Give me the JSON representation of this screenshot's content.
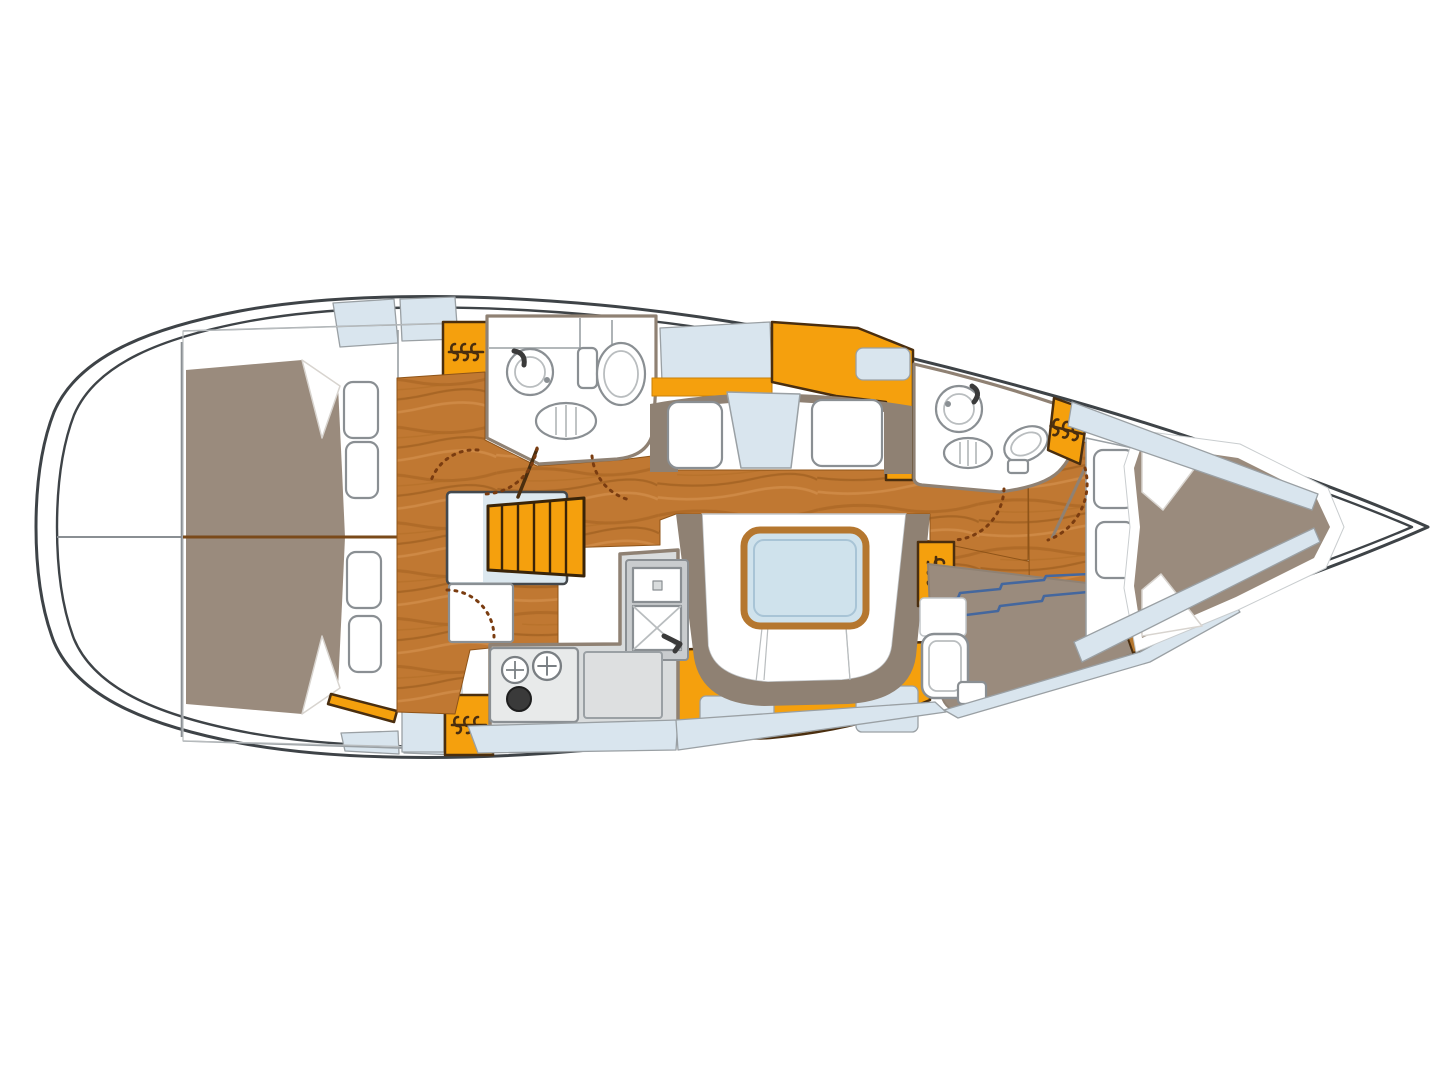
{
  "diagram": {
    "title": "Sailboat interior layout plan (top view)",
    "type": "yacht-floor-plan",
    "orientation": {
      "bow": "right",
      "stern": "left"
    },
    "rooms": [
      {
        "id": "lazarette",
        "name": "Stern lazarette",
        "fixtures": []
      },
      {
        "id": "aft-cabin-top",
        "name": "Aft double cabin (upper)",
        "fixtures": [
          "double-berth",
          "pillow",
          "shelf-locker-hatch",
          "shelf-locker-hatch",
          "hanging-locker",
          "door-swing"
        ]
      },
      {
        "id": "aft-cabin-bottom",
        "name": "Aft double cabin (lower)",
        "fixtures": [
          "double-berth",
          "pillow",
          "shelf-locker-hatch",
          "shelf-locker-hatch",
          "hanging-locker",
          "open-door-leaf",
          "door-swing"
        ]
      },
      {
        "id": "companionway",
        "name": "Companionway",
        "fixtures": [
          "landing",
          "stairs-6-treads",
          "step-box"
        ]
      },
      {
        "id": "aft-head",
        "name": "Aft head (bathroom)",
        "fixtures": [
          "washbasin",
          "faucet",
          "toilet",
          "shower-grate",
          "cabinets",
          "door-leaf",
          "door-swing"
        ]
      },
      {
        "id": "galley",
        "name": "Galley",
        "fixtures": [
          "double-sink",
          "faucet",
          "stove-two-burners-plus-pot",
          "worktop-oven",
          "counter"
        ]
      },
      {
        "id": "saloon",
        "name": "Saloon",
        "fixtures": [
          "straight-settee",
          "folding-armrest-panel",
          "sideboard",
          "u-shaped-settee",
          "saloon-table"
        ]
      },
      {
        "id": "forward-head",
        "name": "Forward head (bathroom)",
        "fixtures": [
          "washbasin",
          "faucet",
          "toilet",
          "shower-grate",
          "door-swing"
        ]
      },
      {
        "id": "nav-station",
        "name": "Chart table / nav station",
        "fixtures": [
          "chart-table",
          "chart-contour-lines",
          "wood-trim-bar",
          "navigator-seat",
          "footrest",
          "hanging-locker"
        ]
      },
      {
        "id": "forward-cabin",
        "name": "Forward V-berth cabin",
        "fixtures": [
          "v-berth",
          "pillow",
          "pillow",
          "shelf-locker-hatch",
          "shelf-locker-hatch",
          "hanging-locker",
          "door-swing",
          "door-leaf"
        ]
      },
      {
        "id": "bow-locker",
        "name": "Bow anchor locker",
        "fixtures": []
      }
    ],
    "deck": [
      "side-deck-panels-stern",
      "side-deck-strip-bow-top",
      "side-deck-strip-bow-bottom"
    ]
  },
  "palette": {
    "hull_line": "#3E4347",
    "outline_gray": "#8A8F93",
    "wood_floor": "#C07832",
    "wood_grain_dark": "#8F5418",
    "wood_trim": "#B5772F",
    "joinery_orange": "#F5A00D",
    "joinery_outline": "#4A2E0F",
    "upholstery_taupe": "#9A8B7D",
    "backrest_taupe": "#8F8173",
    "cushion_white": "#FFFFFF",
    "deck_panel_blue": "#D9E5EE",
    "counter_gray": "#D9DCDD",
    "saloon_table_blue": "#CFE2EC",
    "chart_line_blue": "#44679E"
  }
}
